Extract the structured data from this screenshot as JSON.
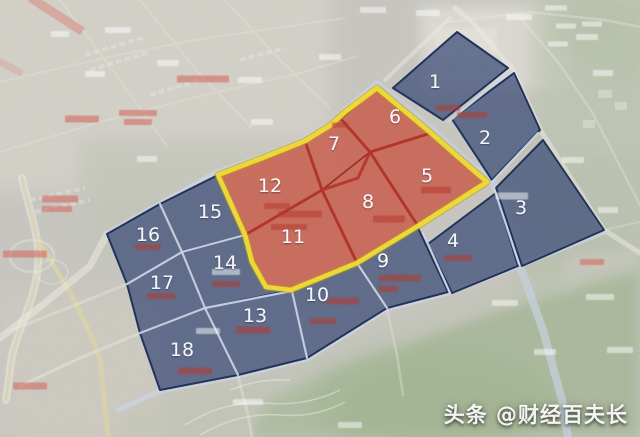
{
  "map": {
    "watermark": "头条 @财经百夫长",
    "label_font_size": 19,
    "colors": {
      "zone_red_fill": "#c95240",
      "zone_red_border": "#9b2b1e",
      "zone_blue_fill": "#3c4e78",
      "zone_blue_border": "#1d2e55",
      "boundary_yellow": "#efdc35",
      "boundary_yellow_edge": "#bf9a10",
      "road_red": "#b33124",
      "road_blue": "#ccd7e6",
      "label_color": "#ffffff",
      "annotation_red": "#b5362c",
      "annotation_pink": "#d4675e",
      "annotation_white": "#ffffff"
    },
    "boundary": {
      "points": [
        [
          218,
          175
        ],
        [
          265,
          157
        ],
        [
          305,
          141
        ],
        [
          331,
          125
        ],
        [
          345,
          112
        ],
        [
          377,
          88
        ],
        [
          431,
          133
        ],
        [
          465,
          163
        ],
        [
          487,
          182
        ],
        [
          418,
          226
        ],
        [
          357,
          263
        ],
        [
          291,
          290
        ],
        [
          266,
          287
        ],
        [
          252,
          262
        ],
        [
          245,
          235
        ]
      ]
    },
    "zones": [
      {
        "number": "1",
        "color": "blue",
        "label": {
          "x": 435,
          "y": 82
        },
        "polygon": [
          [
            393,
            88
          ],
          [
            457,
            32
          ],
          [
            508,
            68
          ],
          [
            443,
            120
          ]
        ]
      },
      {
        "number": "2",
        "color": "blue",
        "label": {
          "x": 485,
          "y": 138
        },
        "polygon": [
          [
            452,
            119
          ],
          [
            514,
            73
          ],
          [
            540,
            130
          ],
          [
            492,
            180
          ]
        ]
      },
      {
        "number": "3",
        "color": "blue",
        "label": {
          "x": 521,
          "y": 208
        },
        "polygon": [
          [
            496,
            188
          ],
          [
            543,
            140
          ],
          [
            604,
            230
          ],
          [
            522,
            266
          ]
        ]
      },
      {
        "number": "4",
        "color": "blue",
        "label": {
          "x": 453,
          "y": 241
        },
        "polygon": [
          [
            428,
            244
          ],
          [
            496,
            193
          ],
          [
            518,
            266
          ],
          [
            452,
            293
          ]
        ]
      },
      {
        "number": "5",
        "color": "red",
        "label": {
          "x": 427,
          "y": 176
        },
        "polygon": [
          [
            370,
            152
          ],
          [
            431,
            133
          ],
          [
            487,
            182
          ],
          [
            418,
            226
          ]
        ]
      },
      {
        "number": "6",
        "color": "red",
        "label": {
          "x": 395,
          "y": 117
        },
        "polygon": [
          [
            341,
            119
          ],
          [
            377,
            88
          ],
          [
            431,
            133
          ],
          [
            370,
            152
          ]
        ]
      },
      {
        "number": "7",
        "color": "red",
        "label": {
          "x": 334,
          "y": 144
        },
        "polygon": [
          [
            305,
            141
          ],
          [
            341,
            119
          ],
          [
            370,
            152
          ],
          [
            322,
            190
          ]
        ]
      },
      {
        "number": "8",
        "color": "red",
        "label": {
          "x": 368,
          "y": 202
        },
        "polygon": [
          [
            322,
            190
          ],
          [
            370,
            152
          ],
          [
            418,
            226
          ],
          [
            357,
            263
          ]
        ]
      },
      {
        "number": "9",
        "color": "blue",
        "label": {
          "x": 383,
          "y": 261
        },
        "polygon": [
          [
            357,
            263
          ],
          [
            418,
            228
          ],
          [
            448,
            292
          ],
          [
            387,
            308
          ]
        ]
      },
      {
        "number": "10",
        "color": "blue",
        "label": {
          "x": 317,
          "y": 295
        },
        "polygon": [
          [
            292,
            291
          ],
          [
            357,
            263
          ],
          [
            387,
            308
          ],
          [
            307,
            358
          ]
        ]
      },
      {
        "number": "11",
        "color": "red",
        "label": {
          "x": 293,
          "y": 237
        },
        "polygon": [
          [
            245,
            235
          ],
          [
            322,
            190
          ],
          [
            357,
            263
          ],
          [
            291,
            290
          ],
          [
            266,
            287
          ],
          [
            252,
            262
          ]
        ]
      },
      {
        "number": "12",
        "color": "red",
        "label": {
          "x": 270,
          "y": 186
        },
        "polygon": [
          [
            218,
            175
          ],
          [
            305,
            141
          ],
          [
            322,
            190
          ],
          [
            245,
            235
          ]
        ]
      },
      {
        "number": "13",
        "color": "blue",
        "label": {
          "x": 255,
          "y": 316
        },
        "polygon": [
          [
            205,
            308
          ],
          [
            292,
            291
          ],
          [
            307,
            358
          ],
          [
            238,
            375
          ]
        ]
      },
      {
        "number": "14",
        "color": "blue",
        "label": {
          "x": 225,
          "y": 263
        },
        "polygon": [
          [
            182,
            252
          ],
          [
            245,
            235
          ],
          [
            252,
            262
          ],
          [
            266,
            287
          ],
          [
            291,
            290
          ],
          [
            205,
            308
          ]
        ]
      },
      {
        "number": "15",
        "color": "blue",
        "label": {
          "x": 210,
          "y": 212
        },
        "polygon": [
          [
            160,
            204
          ],
          [
            218,
            175
          ],
          [
            245,
            235
          ],
          [
            182,
            252
          ]
        ]
      },
      {
        "number": "16",
        "color": "blue",
        "label": {
          "x": 148,
          "y": 235
        },
        "polygon": [
          [
            107,
            234
          ],
          [
            160,
            204
          ],
          [
            182,
            252
          ],
          [
            127,
            284
          ]
        ]
      },
      {
        "number": "17",
        "color": "blue",
        "label": {
          "x": 162,
          "y": 283
        },
        "polygon": [
          [
            127,
            284
          ],
          [
            182,
            252
          ],
          [
            205,
            308
          ],
          [
            140,
            333
          ]
        ]
      },
      {
        "number": "18",
        "color": "blue",
        "label": {
          "x": 182,
          "y": 350
        },
        "polygon": [
          [
            140,
            333
          ],
          [
            205,
            308
          ],
          [
            238,
            375
          ],
          [
            160,
            390
          ]
        ]
      }
    ],
    "inner_roads": {
      "red": [
        [
          [
            305,
            141
          ],
          [
            322,
            190
          ]
        ],
        [
          [
            341,
            119
          ],
          [
            370,
            152
          ]
        ],
        [
          [
            322,
            190
          ],
          [
            358,
            178
          ],
          [
            370,
            152
          ]
        ],
        [
          [
            370,
            152
          ],
          [
            431,
            133
          ]
        ],
        [
          [
            370,
            152
          ],
          [
            418,
            226
          ]
        ],
        [
          [
            245,
            235
          ],
          [
            322,
            190
          ]
        ],
        [
          [
            322,
            190
          ],
          [
            357,
            263
          ]
        ]
      ],
      "blue": [
        [
          [
            160,
            204
          ],
          [
            182,
            252
          ]
        ],
        [
          [
            127,
            284
          ],
          [
            182,
            252
          ]
        ],
        [
          [
            182,
            252
          ],
          [
            245,
            235
          ]
        ],
        [
          [
            182,
            252
          ],
          [
            205,
            308
          ]
        ],
        [
          [
            140,
            333
          ],
          [
            205,
            308
          ]
        ],
        [
          [
            205,
            308
          ],
          [
            292,
            291
          ]
        ],
        [
          [
            205,
            308
          ],
          [
            238,
            375
          ]
        ],
        [
          [
            292,
            291
          ],
          [
            307,
            358
          ]
        ],
        [
          [
            357,
            263
          ],
          [
            387,
            308
          ]
        ],
        [
          [
            423,
            233
          ],
          [
            450,
            293
          ]
        ],
        [
          [
            494,
            188
          ],
          [
            519,
            264
          ]
        ],
        [
          [
            492,
            182
          ],
          [
            538,
            133
          ]
        ],
        [
          [
            448,
            122
          ],
          [
            512,
            70
          ]
        ]
      ]
    },
    "annotations": [
      {
        "x": 448,
        "y": 108,
        "w": 24,
        "h": 6,
        "color": "red"
      },
      {
        "x": 472,
        "y": 115,
        "w": 30,
        "h": 6,
        "color": "red"
      },
      {
        "x": 436,
        "y": 190,
        "w": 30,
        "h": 7,
        "color": "red"
      },
      {
        "x": 389,
        "y": 219,
        "w": 32,
        "h": 7,
        "color": "red"
      },
      {
        "x": 300,
        "y": 214,
        "w": 44,
        "h": 7,
        "color": "red"
      },
      {
        "x": 289,
        "y": 227,
        "w": 36,
        "h": 6,
        "color": "red"
      },
      {
        "x": 277,
        "y": 206,
        "w": 26,
        "h": 6,
        "color": "red"
      },
      {
        "x": 400,
        "y": 278,
        "w": 42,
        "h": 7,
        "color": "red"
      },
      {
        "x": 388,
        "y": 289,
        "w": 20,
        "h": 6,
        "color": "red"
      },
      {
        "x": 343,
        "y": 301,
        "w": 32,
        "h": 7,
        "color": "red"
      },
      {
        "x": 323,
        "y": 321,
        "w": 26,
        "h": 6,
        "color": "red"
      },
      {
        "x": 253,
        "y": 330,
        "w": 34,
        "h": 7,
        "color": "red"
      },
      {
        "x": 226,
        "y": 284,
        "w": 28,
        "h": 6,
        "color": "red"
      },
      {
        "x": 148,
        "y": 247,
        "w": 26,
        "h": 6,
        "color": "red"
      },
      {
        "x": 161,
        "y": 296,
        "w": 28,
        "h": 6,
        "color": "red"
      },
      {
        "x": 195,
        "y": 371,
        "w": 34,
        "h": 7,
        "color": "red"
      },
      {
        "x": 458,
        "y": 258,
        "w": 28,
        "h": 6,
        "color": "red"
      },
      {
        "x": 340,
        "y": 125,
        "w": 16,
        "h": 5,
        "color": "red"
      },
      {
        "x": 82,
        "y": 119,
        "w": 34,
        "h": 7,
        "color": "pink"
      },
      {
        "x": 138,
        "y": 113,
        "w": 38,
        "h": 6,
        "color": "pink"
      },
      {
        "x": 138,
        "y": 122,
        "w": 28,
        "h": 6,
        "color": "pink"
      },
      {
        "x": 60,
        "y": 199,
        "w": 36,
        "h": 7,
        "color": "pink"
      },
      {
        "x": 57,
        "y": 209,
        "w": 30,
        "h": 6,
        "color": "pink"
      },
      {
        "x": 25,
        "y": 254,
        "w": 44,
        "h": 7,
        "color": "pink"
      },
      {
        "x": 203,
        "y": 79,
        "w": 52,
        "h": 7,
        "color": "pink"
      },
      {
        "x": 30,
        "y": 386,
        "w": 34,
        "h": 7,
        "color": "pink"
      },
      {
        "x": 592,
        "y": 262,
        "w": 24,
        "h": 6,
        "color": "pink"
      },
      {
        "x": 118,
        "y": 30,
        "w": 26,
        "h": 6,
        "color": "white"
      },
      {
        "x": 168,
        "y": 63,
        "w": 22,
        "h": 6,
        "color": "white"
      },
      {
        "x": 250,
        "y": 80,
        "w": 24,
        "h": 6,
        "color": "white"
      },
      {
        "x": 330,
        "y": 57,
        "w": 22,
        "h": 6,
        "color": "white"
      },
      {
        "x": 373,
        "y": 10,
        "w": 26,
        "h": 6,
        "color": "white"
      },
      {
        "x": 428,
        "y": 13,
        "w": 24,
        "h": 6,
        "color": "white"
      },
      {
        "x": 519,
        "y": 17,
        "w": 26,
        "h": 6,
        "color": "white"
      },
      {
        "x": 587,
        "y": 37,
        "w": 22,
        "h": 6,
        "color": "white"
      },
      {
        "x": 603,
        "y": 73,
        "w": 20,
        "h": 6,
        "color": "white"
      },
      {
        "x": 262,
        "y": 122,
        "w": 22,
        "h": 6,
        "color": "white"
      },
      {
        "x": 147,
        "y": 159,
        "w": 20,
        "h": 6,
        "color": "white"
      },
      {
        "x": 95,
        "y": 74,
        "w": 20,
        "h": 6,
        "color": "white"
      },
      {
        "x": 60,
        "y": 34,
        "w": 18,
        "h": 6,
        "color": "white"
      },
      {
        "x": 573,
        "y": 160,
        "w": 22,
        "h": 6,
        "color": "white"
      },
      {
        "x": 608,
        "y": 210,
        "w": 20,
        "h": 6,
        "color": "white"
      },
      {
        "x": 512,
        "y": 196,
        "w": 32,
        "h": 7,
        "color": "white"
      },
      {
        "x": 226,
        "y": 272,
        "w": 28,
        "h": 6,
        "color": "white"
      },
      {
        "x": 208,
        "y": 331,
        "w": 24,
        "h": 6,
        "color": "white"
      },
      {
        "x": 248,
        "y": 402,
        "w": 30,
        "h": 6,
        "color": "white"
      },
      {
        "x": 505,
        "y": 303,
        "w": 26,
        "h": 6,
        "color": "white"
      },
      {
        "x": 600,
        "y": 297,
        "w": 28,
        "h": 6,
        "color": "white"
      },
      {
        "x": 620,
        "y": 350,
        "w": 26,
        "h": 6,
        "color": "white"
      },
      {
        "x": 545,
        "y": 352,
        "w": 22,
        "h": 6,
        "color": "white"
      },
      {
        "x": 350,
        "y": 425,
        "w": 24,
        "h": 6,
        "color": "white"
      },
      {
        "x": 556,
        "y": 8,
        "w": 22,
        "h": 5,
        "color": "white"
      },
      {
        "x": 566,
        "y": 26,
        "w": 20,
        "h": 5,
        "color": "white"
      },
      {
        "x": 592,
        "y": 24,
        "w": 20,
        "h": 5,
        "color": "white"
      },
      {
        "x": 558,
        "y": 44,
        "w": 20,
        "h": 5,
        "color": "white"
      }
    ]
  }
}
